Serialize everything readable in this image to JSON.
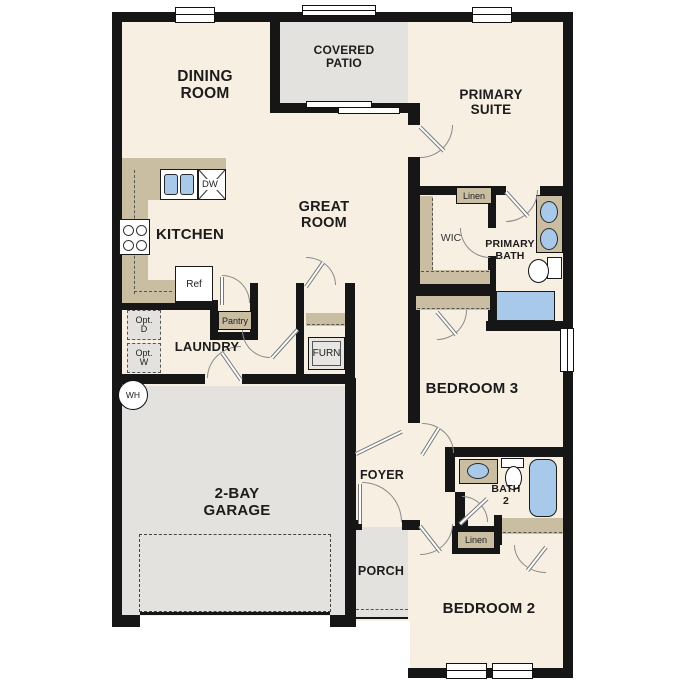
{
  "title": "Single-story house floor plan",
  "colors": {
    "wall": "#161616",
    "interior_floor": "#f7efe2",
    "outdoor_concrete": "#e3e2df",
    "counter_tan": "#c9bda2",
    "fixture_blue": "#a9c9eb",
    "background": "#ffffff"
  },
  "labels": {
    "dining": "DINING\nROOM",
    "covered_patio": "COVERED\nPATIO",
    "primary_suite": "PRIMARY\nSUITE",
    "great_room": "GREAT\nROOM",
    "kitchen": "KITCHEN",
    "wic": "WIC",
    "primary_bath": "PRIMARY\nBATH",
    "linen_primary": "Linen",
    "linen_hall": "Linen",
    "pantry": "Pantry",
    "laundry": "LAUNDRY",
    "furnace": "FURN",
    "bedroom3": "BEDROOM 3",
    "bedroom2": "BEDROOM 2",
    "bath2": "BATH\n2",
    "foyer": "FOYER",
    "garage": "2-BAY\nGARAGE",
    "porch": "PORCH",
    "refrigerator": "Ref",
    "dishwasher": "DW",
    "optional_dryer": "Opt.\nD",
    "optional_washer": "Opt.\nW",
    "water_heater": "WH"
  }
}
